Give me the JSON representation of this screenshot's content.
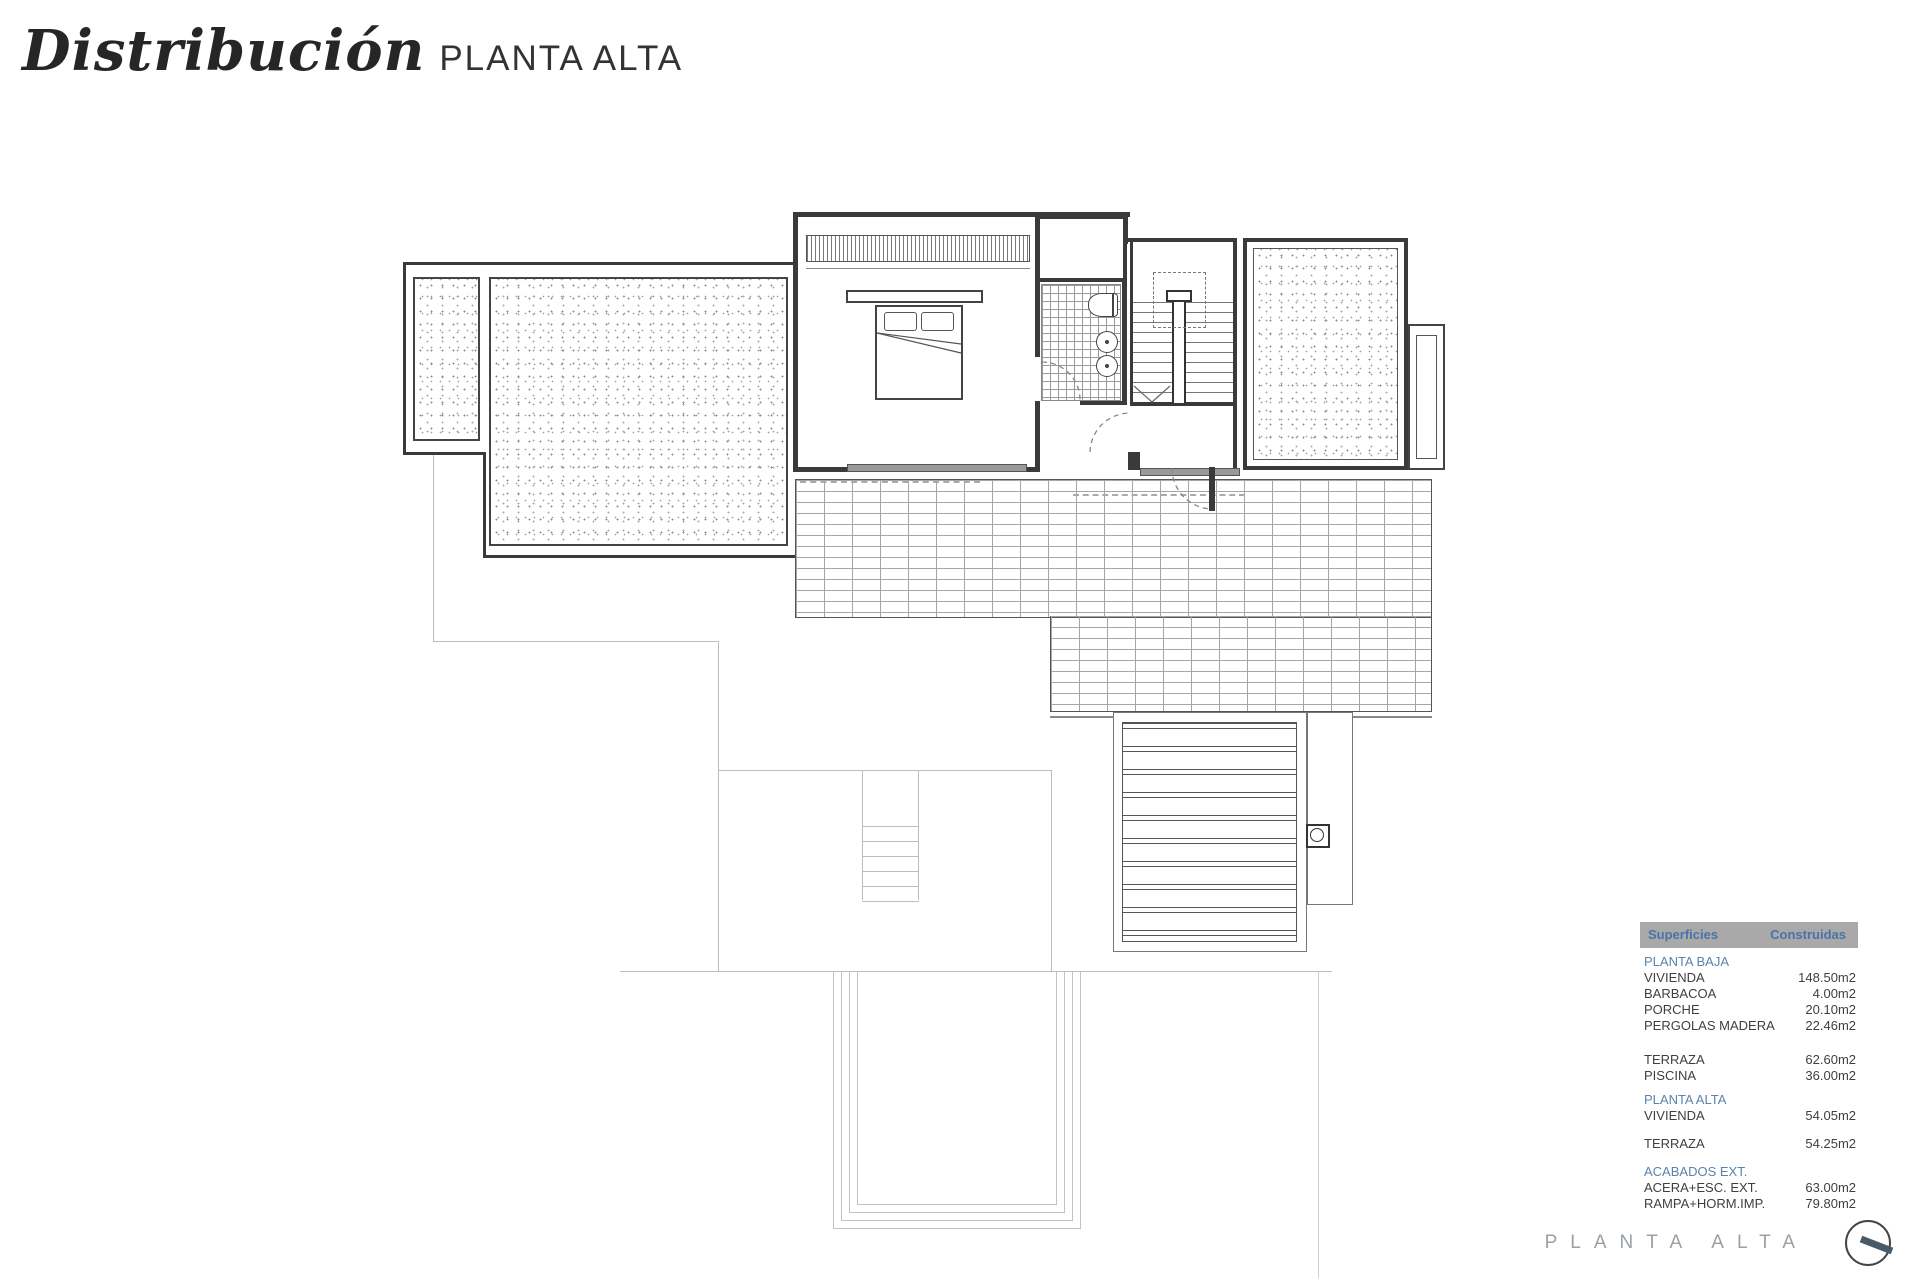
{
  "title": {
    "main": "Distribución",
    "sub": "PLANTA ALTA"
  },
  "footer": {
    "label": "PLANTA ALTA"
  },
  "colors": {
    "accent_blue": "#4a73a8",
    "section_blue": "#5b84a9",
    "header_gray": "#a9a9a9",
    "wall_dark": "#3a3a3a"
  },
  "table": {
    "header": {
      "col1": "Superficies",
      "col2": "Construidas"
    },
    "sections": [
      {
        "title": "PLANTA BAJA",
        "rows": [
          {
            "label": "VIVIENDA",
            "value": "148.50m2"
          },
          {
            "label": "BARBACOA",
            "value": "4.00m2"
          },
          {
            "label": "PORCHE",
            "value": "20.10m2"
          },
          {
            "label": "PERGOLAS MADERA",
            "value": "22.46m2"
          }
        ]
      },
      {
        "title": "",
        "rows": [
          {
            "label": "TERRAZA",
            "value": "62.60m2"
          },
          {
            "label": "PISCINA",
            "value": "36.00m2"
          }
        ]
      },
      {
        "title": "PLANTA ALTA",
        "rows": [
          {
            "label": "VIVIENDA",
            "value": "54.05m2"
          }
        ]
      },
      {
        "title": "",
        "rows": [
          {
            "label": "TERRAZA",
            "value": "54.25m2"
          }
        ]
      },
      {
        "title": "ACABADOS EXT.",
        "rows": [
          {
            "label": "ACERA+ESC. EXT.",
            "value": "63.00m2"
          },
          {
            "label": "RAMPA+HORM.IMP.",
            "value": "79.80m2"
          }
        ]
      }
    ]
  }
}
